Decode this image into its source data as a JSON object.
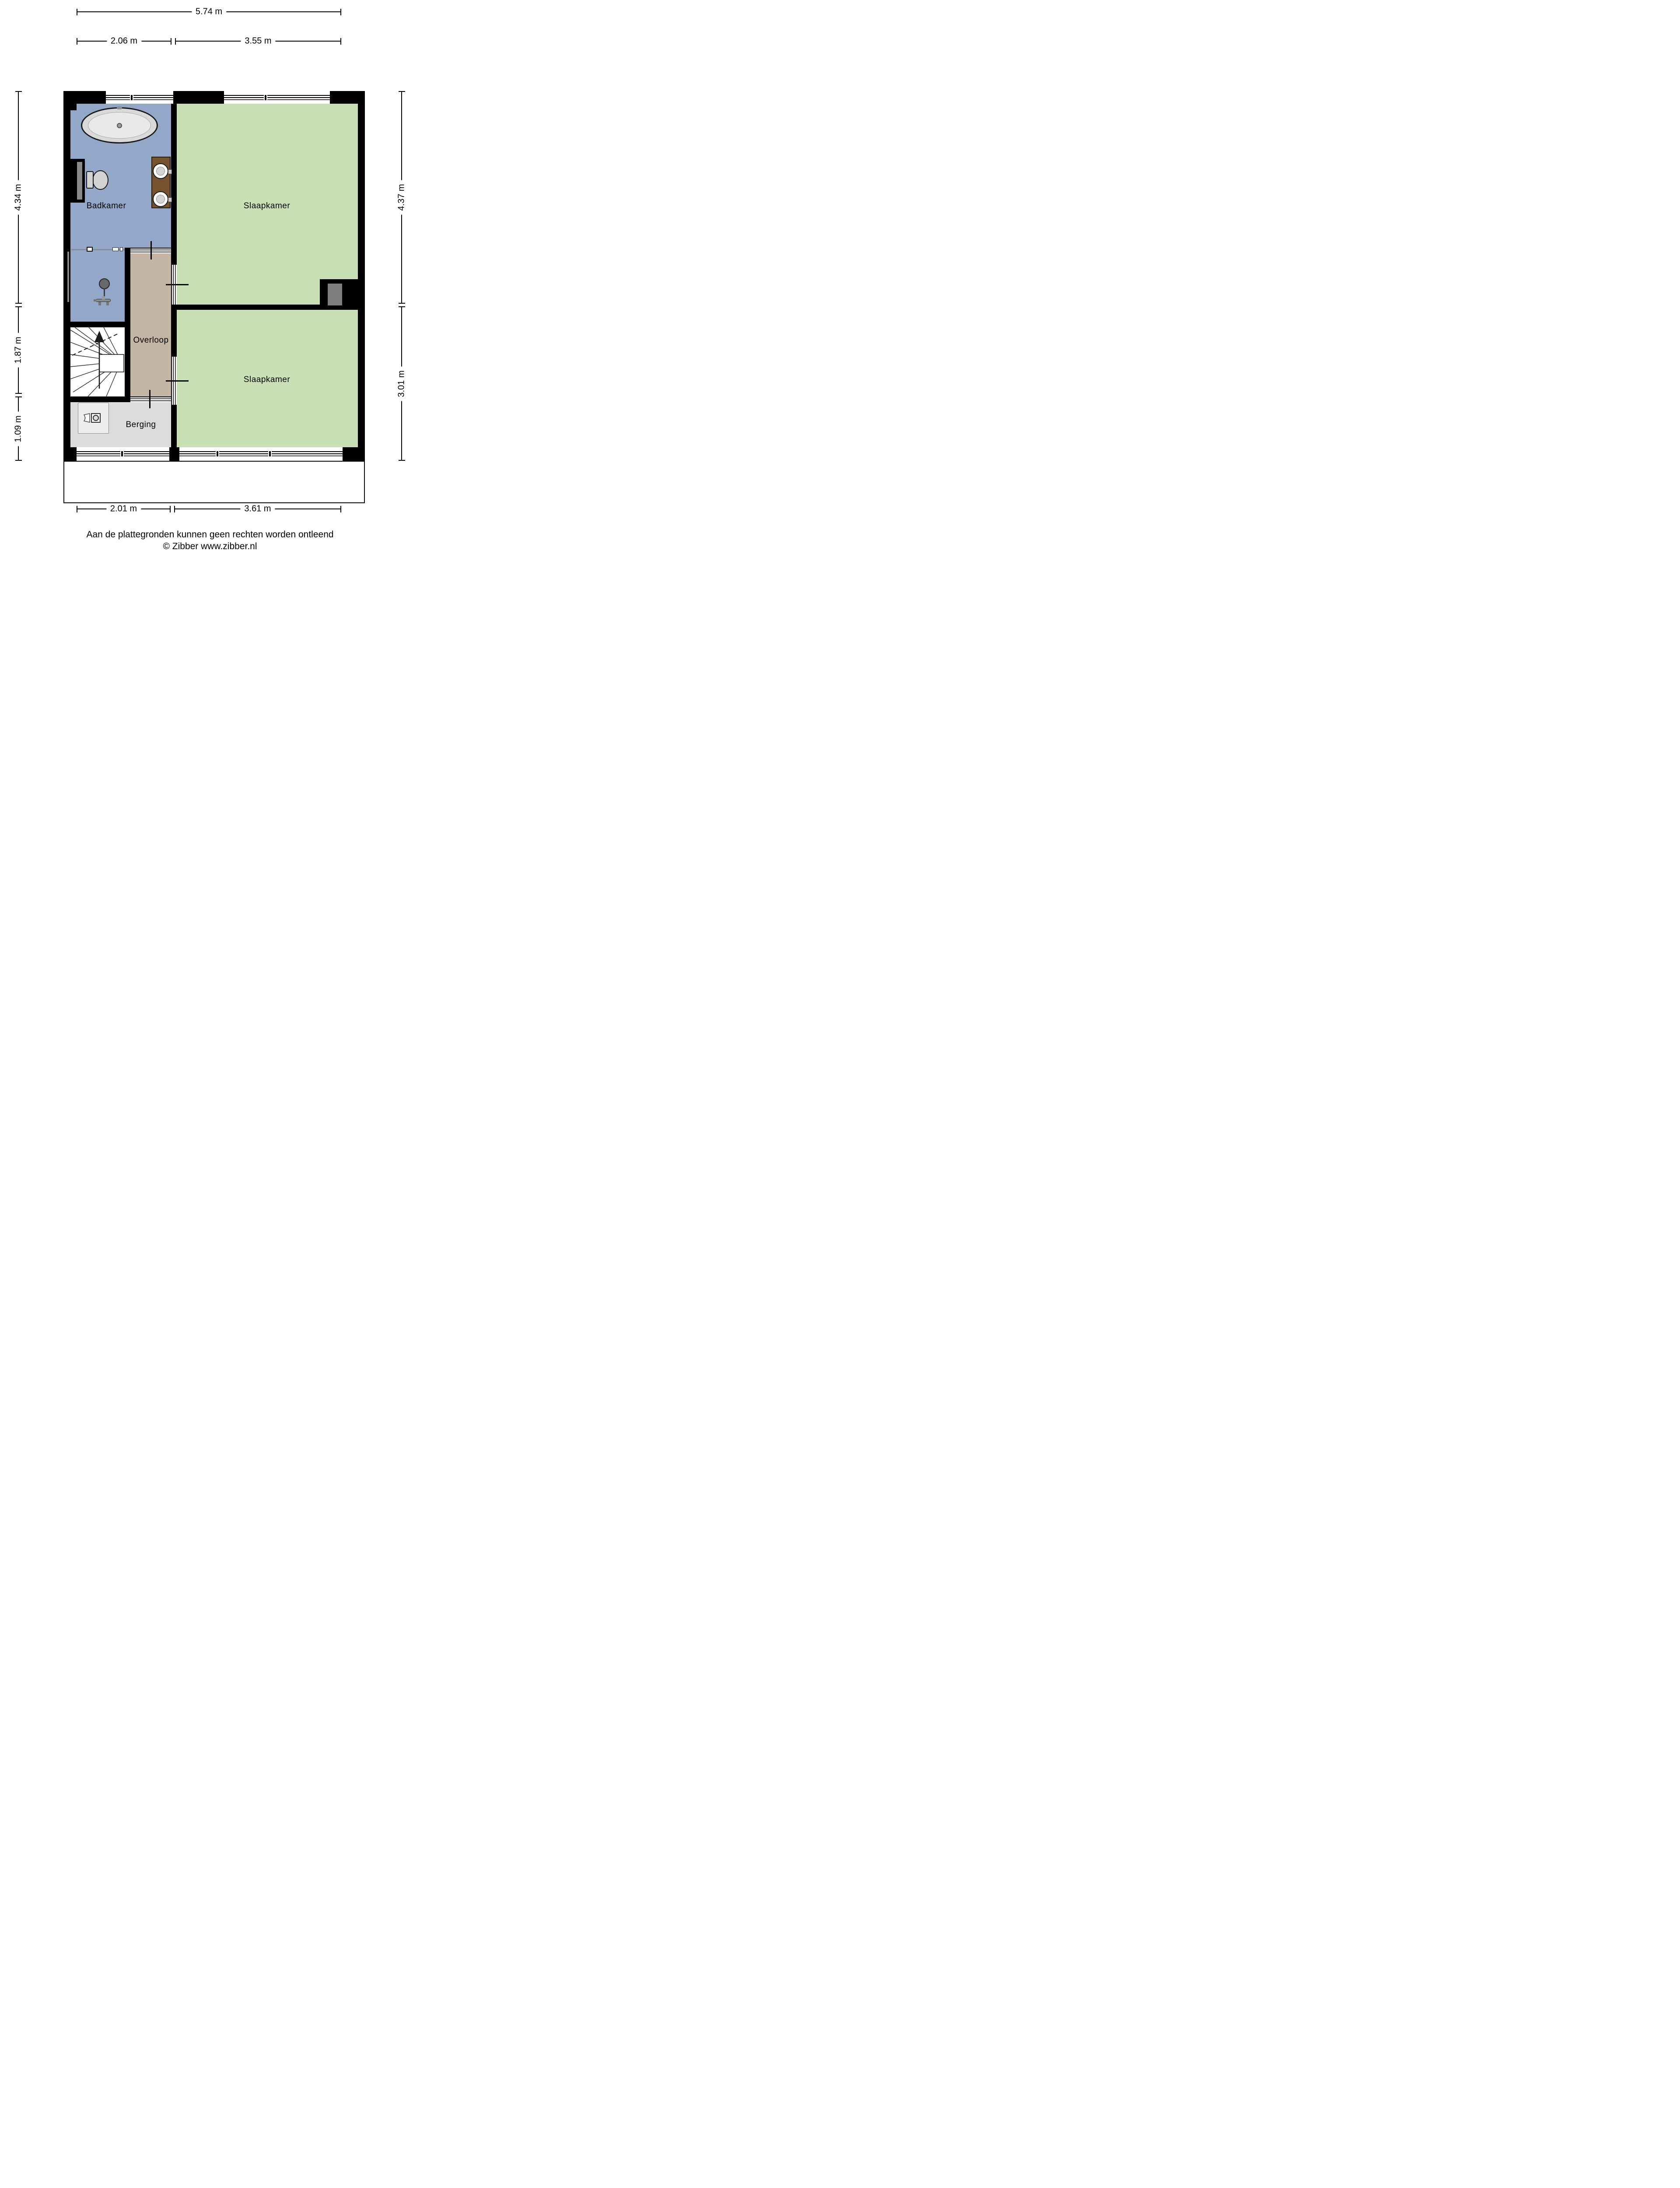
{
  "rooms": {
    "badkamer": {
      "label": "Badkamer"
    },
    "slaapkamer_top": {
      "label": "Slaapkamer"
    },
    "overloop": {
      "label": "Overloop"
    },
    "slaapkamer_bottom": {
      "label": "Slaapkamer"
    },
    "berging": {
      "label": "Berging"
    }
  },
  "dimensions": {
    "top_total": "5.74 m",
    "top_segments": [
      "2.06 m",
      "3.55 m"
    ],
    "left_segments": [
      "4.34 m",
      "1.87 m",
      "1.09 m"
    ],
    "right_segments": [
      "4.37 m",
      "3.01 m"
    ],
    "bottom_segments": [
      "2.01 m",
      "3.61 m"
    ]
  },
  "footer": {
    "disclaimer": "Aan de plattegronden kunnen geen rechten worden ontleend",
    "copyright": "© Zibber www.zibber.nl"
  },
  "icons": [
    "bathtub-icon",
    "toilet-icon",
    "double-sink-icon",
    "shower-icon",
    "staircase-up-icon",
    "washing-machine-icon",
    "laundry-basket-icon"
  ],
  "colors": {
    "wall": "#000000",
    "bathroom_floor": "#93a7c9",
    "bedroom_floor": "#c9dfb4",
    "landing_floor": "#c3b4a3",
    "storage_floor": "#dcdcdc",
    "background": "#ffffff"
  }
}
